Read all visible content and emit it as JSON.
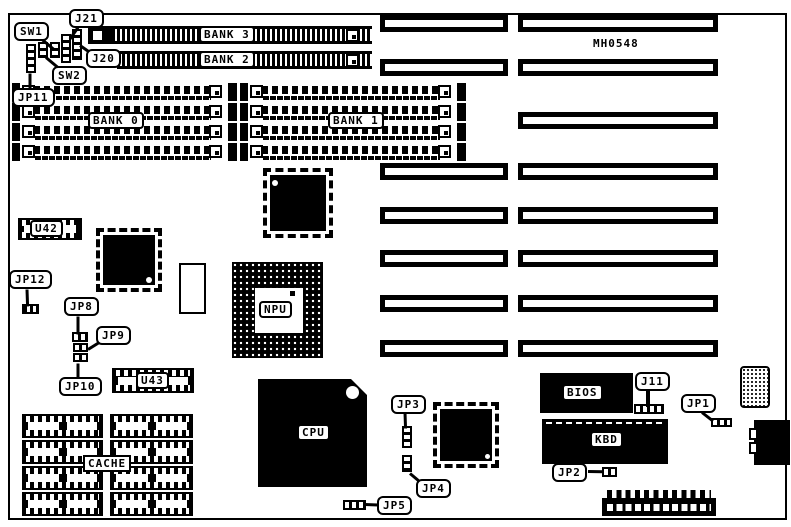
{
  "figure": {
    "type": "motherboard-component-location-diagram",
    "board_code": "MH0548"
  },
  "colors": {
    "ink": "#000000",
    "paper": "#ffffff"
  },
  "callouts": {
    "sw1": "SW1",
    "sw2": "SW2",
    "j21": "J21",
    "j20": "J20",
    "jp11": "JP11",
    "jp12": "JP12",
    "jp8": "JP8",
    "jp9": "JP9",
    "jp10": "JP10",
    "jp3": "JP3",
    "jp4": "JP4",
    "jp5": "JP5",
    "j11": "J11",
    "jp1": "JP1",
    "jp2": "JP2"
  },
  "component_labels": {
    "bank0": "BANK 0",
    "bank1": "BANK 1",
    "bank2": "BANK 2",
    "bank3": "BANK 3",
    "u42": "U42",
    "u43": "U43",
    "npu": "NPU",
    "cpu": "CPU",
    "cache": "CACHE",
    "bios": "BIOS",
    "kbd": "KBD"
  }
}
